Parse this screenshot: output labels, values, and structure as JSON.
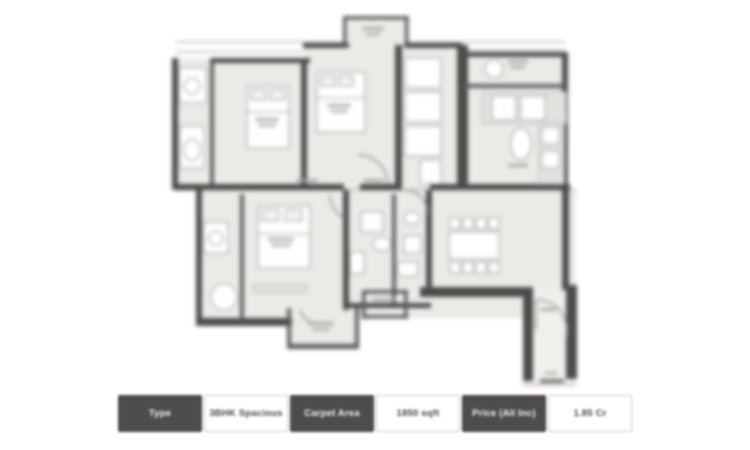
{
  "page": {
    "background_color": "#ffffff",
    "content": "Apartment floor plan with property info strip"
  },
  "floorplan": {
    "kind": "residential-apartment-floor-plan",
    "floor_color": "#eceae7",
    "wall_color": "#4b4b4b",
    "fixture_stroke_color": "#9a9a9a",
    "rooms_visible": "bedrooms with beds, bathrooms with fixtures, kitchen with counters, dining table with chairs, balconies, entrance foyer with door swing"
  },
  "info_bar": {
    "dark_color": "#4f4d4c",
    "light_color": "#ffffff",
    "items": [
      {
        "label": "Type",
        "style": "dark"
      },
      {
        "label": "3BHK Spacious",
        "style": "light"
      },
      {
        "label": "Carpet Area",
        "style": "dark"
      },
      {
        "label": "1850 sqft",
        "style": "light"
      },
      {
        "label": "Price (All Inc)",
        "style": "dark"
      },
      {
        "label": "1.85 Cr",
        "style": "light"
      }
    ]
  }
}
